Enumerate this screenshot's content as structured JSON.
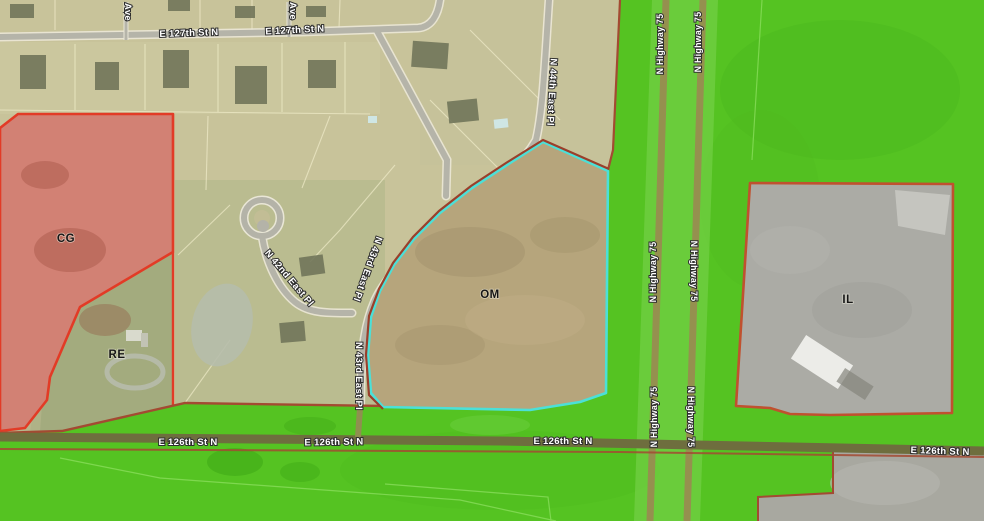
{
  "map": {
    "title": "zoning-aerial-map",
    "zones": {
      "cg": {
        "label": "CG",
        "fill": "#d28174",
        "border": "#e23b26"
      },
      "re": {
        "label": "RE",
        "fill": "none",
        "border": "#e23b26"
      },
      "om": {
        "label": "OM",
        "fill": "#b6a57c",
        "border": "#4be0d8",
        "border_outer": "#9a3f2b"
      },
      "il": {
        "label": "IL",
        "fill": "#ababa5",
        "border": "#c0512f"
      },
      "green": {
        "fill": "#55c322",
        "border": "#a34a32"
      }
    },
    "streets": {
      "e127": {
        "name": "E 127th St N"
      },
      "e126": {
        "name": "E 126th St N"
      },
      "hwy": {
        "name": "N Highway 75"
      },
      "n44": {
        "name": "N 44th East Pl"
      },
      "n43": {
        "name": "N 43rd East Pl"
      },
      "n42": {
        "name": "N 42nd East Pl"
      },
      "ave": {
        "name": "Ave"
      }
    }
  }
}
